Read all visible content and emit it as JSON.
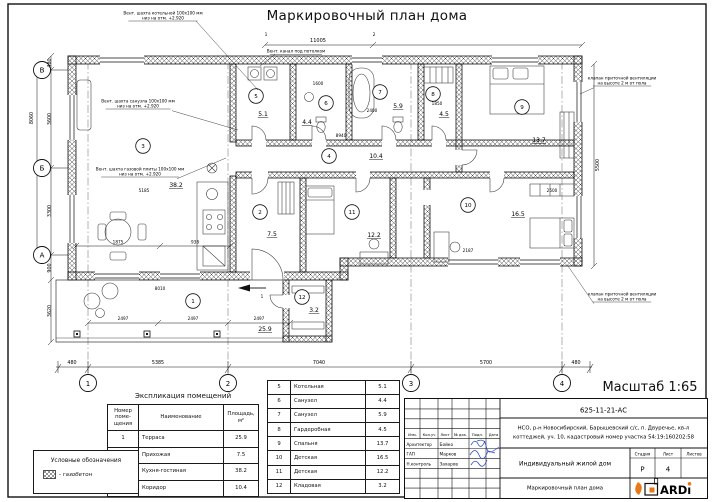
{
  "page": {
    "title": "Маркировочный план дома",
    "scale": "Масштаб 1:65"
  },
  "legend": {
    "title": "Условные обозначения",
    "item_label": "- газобетон"
  },
  "explication": {
    "title": "Экспликация помещений",
    "col_num": "Номер\nпоме-\nщения",
    "col_name": "Наименование",
    "col_area": "Площадь,\nм²",
    "rooms": [
      {
        "num": "1",
        "name": "Терраса",
        "area": "25.9"
      },
      {
        "num": "2",
        "name": "Прихожая",
        "area": "7.5"
      },
      {
        "num": "3",
        "name": "Кухня-гостиная",
        "area": "38.2"
      },
      {
        "num": "4",
        "name": "Коридор",
        "area": "10.4"
      },
      {
        "num": "5",
        "name": "Котельная",
        "area": "5.1"
      },
      {
        "num": "6",
        "name": "Санузел",
        "area": "4.4"
      },
      {
        "num": "7",
        "name": "Санузел",
        "area": "5.9"
      },
      {
        "num": "8",
        "name": "Гардеробная",
        "area": "4.5"
      },
      {
        "num": "9",
        "name": "Спальня",
        "area": "13.7"
      },
      {
        "num": "10",
        "name": "Детская",
        "area": "16.5"
      },
      {
        "num": "11",
        "name": "Детская",
        "area": "12.2"
      },
      {
        "num": "12",
        "name": "Кладовая",
        "area": "3.2"
      }
    ]
  },
  "plan": {
    "rooms": [
      {
        "num": "1",
        "cx": 193,
        "cy": 301,
        "area": "25.9",
        "ax": 265,
        "ay": 331
      },
      {
        "num": "2",
        "cx": 260,
        "cy": 212,
        "area": "7.5",
        "ax": 272,
        "ay": 236
      },
      {
        "num": "3",
        "cx": 143,
        "cy": 146,
        "area": "38.2",
        "ax": 176,
        "ay": 187
      },
      {
        "num": "4",
        "cx": 329,
        "cy": 156,
        "area": "10.4",
        "ax": 376,
        "ay": 158
      },
      {
        "num": "5",
        "cx": 256,
        "cy": 96,
        "area": "5.1",
        "ax": 263,
        "ay": 116
      },
      {
        "num": "6",
        "cx": 326,
        "cy": 103,
        "area": "4.4",
        "ax": 307,
        "ay": 124
      },
      {
        "num": "7",
        "cx": 380,
        "cy": 92,
        "area": "5.9",
        "ax": 398,
        "ay": 108
      },
      {
        "num": "8",
        "cx": 433,
        "cy": 94,
        "area": "4.5",
        "ax": 444,
        "ay": 116
      },
      {
        "num": "9",
        "cx": 522,
        "cy": 107,
        "area": "13.7",
        "ax": 539,
        "ay": 142
      },
      {
        "num": "10",
        "cx": 468,
        "cy": 205,
        "area": "16.5",
        "ax": 518,
        "ay": 216
      },
      {
        "num": "11",
        "cx": 352,
        "cy": 212,
        "area": "12.2",
        "ax": 374,
        "ay": 237
      },
      {
        "num": "12",
        "cx": 302,
        "cy": 297,
        "area": "3.2",
        "ax": 314,
        "ay": 312
      }
    ],
    "axes_bottom": [
      {
        "l": "1",
        "x": 88
      },
      {
        "l": "2",
        "x": 228
      },
      {
        "l": "3",
        "x": 411
      },
      {
        "l": "4",
        "x": 562
      }
    ],
    "axes_left": [
      {
        "l": "В",
        "y": 70
      },
      {
        "l": "Б",
        "y": 168
      },
      {
        "l": "А",
        "y": 255
      }
    ],
    "dim_labels": [
      {
        "t": "480",
        "x": 72,
        "y": 364
      },
      {
        "t": "5385",
        "x": 158,
        "y": 364
      },
      {
        "t": "7040",
        "x": 319,
        "y": 364
      },
      {
        "t": "5700",
        "x": 486,
        "y": 364
      },
      {
        "t": "480",
        "x": 576,
        "y": 364
      },
      {
        "t": "11005",
        "x": 318,
        "y": 42,
        "fs": 5
      },
      {
        "t": "1",
        "x": 266,
        "y": 36,
        "fs": 4.4
      },
      {
        "t": "2",
        "x": 374,
        "y": 36,
        "fs": 4.4
      },
      {
        "t": "480",
        "x": 51,
        "y": 63,
        "r": 1
      },
      {
        "t": "3600",
        "x": 51,
        "y": 119,
        "r": 1
      },
      {
        "t": "3300",
        "x": 51,
        "y": 211,
        "r": 1
      },
      {
        "t": "900",
        "x": 51,
        "y": 268,
        "r": 1
      },
      {
        "t": "3620",
        "x": 51,
        "y": 311,
        "r": 1
      },
      {
        "t": "8060",
        "x": 33,
        "y": 118,
        "r": 1
      },
      {
        "t": "5500",
        "x": 599,
        "y": 165,
        "r": 1
      },
      {
        "t": "8940",
        "x": 341,
        "y": 137,
        "fs": 4.2
      },
      {
        "t": "5185",
        "x": 144,
        "y": 192,
        "fs": 4.2
      },
      {
        "t": "1875",
        "x": 118,
        "y": 243.5,
        "fs": 4.2
      },
      {
        "t": "938",
        "x": 195,
        "y": 243.5,
        "fs": 4.2
      },
      {
        "t": "2497",
        "x": 123,
        "y": 320,
        "fs": 4.2
      },
      {
        "t": "2497",
        "x": 193,
        "y": 320,
        "fs": 4.2
      },
      {
        "t": "2497",
        "x": 259,
        "y": 320,
        "fs": 4.2
      },
      {
        "t": "2500",
        "x": 552,
        "y": 192,
        "fs": 4.2
      },
      {
        "t": "1600",
        "x": 318,
        "y": 85,
        "fs": 4.2
      },
      {
        "t": "2400",
        "x": 372,
        "y": 112,
        "fs": 4.2
      },
      {
        "t": "1850",
        "x": 437,
        "y": 105,
        "fs": 4.2
      },
      {
        "t": "2187",
        "x": 468,
        "y": 252,
        "fs": 4.2
      },
      {
        "t": "8010",
        "x": 160,
        "y": 290,
        "fs": 4.2
      },
      {
        "t": "1",
        "x": 262,
        "y": 298,
        "fs": 4.2
      }
    ],
    "annotations": [
      {
        "lines": [
          "Вент. шахта котельной 100х100 мм",
          "низ на отм. +2.920"
        ],
        "x": 163,
        "y": 11,
        "leader": [
          196,
          21,
          258,
          90
        ]
      },
      {
        "lines": [
          "Вент. канал под потолком"
        ],
        "x": 296,
        "y": 49,
        "leader": [
          275,
          54.3,
          260,
          66
        ]
      },
      {
        "lines": [
          "Вент. шахта санузла 100х100 мм",
          "низ на отм. +2.920"
        ],
        "x": 138,
        "y": 99,
        "leader": [
          172,
          110.7,
          238,
          130
        ]
      },
      {
        "lines": [
          "Вент. шахта газовой плиты 100х100 мм",
          "низ на отм. +2.920"
        ],
        "x": 140,
        "y": 167,
        "leader": [
          177,
          178.7,
          226,
          158
        ]
      },
      {
        "lines": [
          "клапан приточной вентиляции",
          "на высоте 2 м от пола"
        ],
        "x": 622,
        "y": 76,
        "leader": [
          594,
          87.7,
          580,
          94
        ]
      },
      {
        "lines": [
          "клапан приточной вентиляции",
          "на высоте 2 м от пола"
        ],
        "x": 622,
        "y": 292,
        "leader": [
          594,
          303.7,
          568,
          266
        ]
      }
    ]
  },
  "title_block": {
    "doc_number": "625-11-21-АС",
    "address1": "НСО, р-н Новосибирский, Барышевский с/с, п. Двуречье, кв-л",
    "address2": "коттеджей, уч. 10, кадастровый номер участка 54:19:160202:58",
    "project": "Индивидуальный жилой дом",
    "sheet_title": "Маркировочный план дома",
    "stage_label": "Стадия",
    "sheet_label": "Лист",
    "sheets_label": "Листов",
    "stage": "Р",
    "sheet_num": "4",
    "header_cols": [
      "Изм.",
      "Кол.уч",
      "Лист",
      "№ док.",
      "Подп.",
      "Дата"
    ],
    "signers": [
      {
        "role": "Архитектор",
        "name": "Бойко"
      },
      {
        "role": "ГАП",
        "name": "Марков"
      },
      {
        "role": "Н.контроль",
        "name": "Захаров"
      }
    ],
    "logo_text": "ARD",
    "logo_color": "#e8791a",
    "signature_color": "#2e4fc4"
  }
}
